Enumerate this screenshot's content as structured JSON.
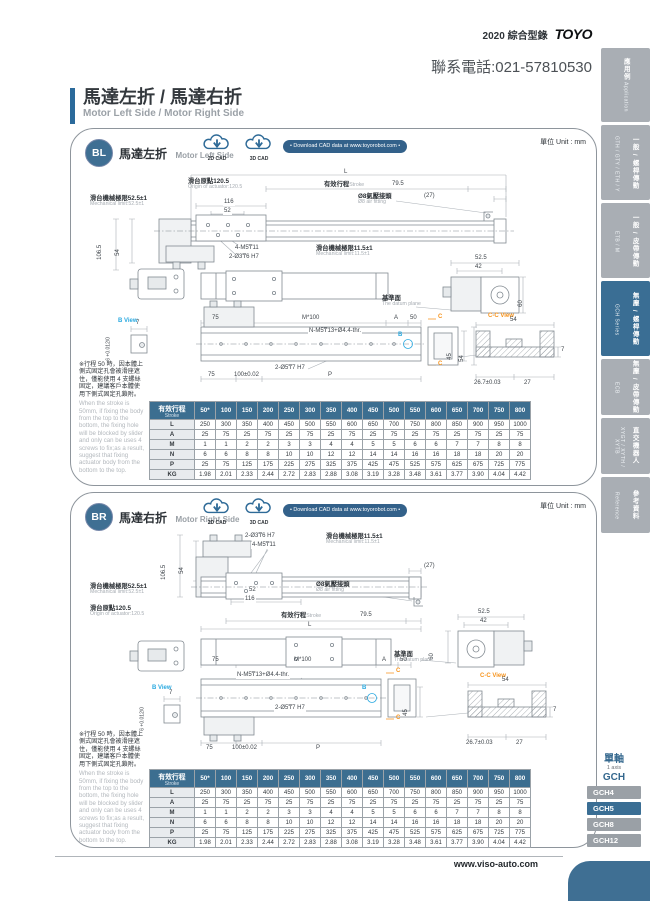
{
  "page": {
    "catalog": "2020 綜合型錄",
    "brand": "TOYO",
    "phone": "聯系電話:021-57810530",
    "unit": "單位 Unit : mm",
    "website": "www.viso-auto.com"
  },
  "title": {
    "zh": "馬達左折 / 馬達右折",
    "en": "Motor Left Side / Motor Right Side"
  },
  "sidebar": {
    "tabs": [
      {
        "zh": "應用例",
        "en": "Application",
        "active": false
      },
      {
        "zh": "一般 / 螺桿傳動",
        "en": "GTH / GTY / ETH / Y",
        "active": false
      },
      {
        "zh": "一般 / 皮帶傳動",
        "en": "ETB / M",
        "active": false
      },
      {
        "zh": "無塵 / 螺桿傳動",
        "en": "GCH Series",
        "active": true
      },
      {
        "zh": "無塵 / 皮帶傳動",
        "en": "ECB",
        "active": false
      },
      {
        "zh": "直交機器人",
        "en": "XYGT / XYTH / XYTB",
        "active": false
      },
      {
        "zh": "參考資料",
        "en": "Reference",
        "active": false
      }
    ],
    "series_nav": {
      "title_zh": "單軸",
      "title_en": "1 axis",
      "series": "GCH",
      "items": [
        {
          "label": "GCH4",
          "active": false
        },
        {
          "label": "GCH5",
          "active": true
        },
        {
          "label": "GCH8",
          "active": false
        },
        {
          "label": "GCH12",
          "active": false
        }
      ]
    }
  },
  "cad": {
    "btn_2d": "2D CAD",
    "btn_3d": "3D CAD",
    "download": "• Download CAD data at www.toyorobot.com •"
  },
  "panels": {
    "bl": {
      "badge": "BL",
      "title_zh": "馬達左折",
      "title_en": "Motor Left Side"
    },
    "br": {
      "badge": "BR",
      "title_zh": "馬達右折",
      "title_en": "Motor Right Side"
    }
  },
  "dims": {
    "L": "L",
    "stroke_zh": "有效行程",
    "stroke_en": "Stroke",
    "origin_zh": "滑台原點120.5",
    "origin_en": "Origin of actuator:120.5",
    "mech52_zh": "滑台機械極限52.5±1",
    "mech52_en": "Mechanical limit:52.5±1",
    "mech115_zh": "滑台機械極限11.5±1",
    "mech115_en": "Mechanical limit:11.5±1",
    "air_zh": "Ø8氣壓接頭",
    "air_en": "Ø8 air fitting",
    "d795": "79.5",
    "d27": "(27)",
    "d116": "116",
    "d52": "52",
    "d1065": "106.5",
    "d54": "54",
    "d45": "45",
    "holes_m5": "4-M5₸11",
    "holes_o3": "2-Ø3₸6 H7",
    "d525": "52.5",
    "d42": "42",
    "d60": "60",
    "datum_zh": "基準面",
    "datum_en": "The datum plane",
    "d75": "75",
    "m100": "M*100",
    "dA": "A",
    "d50": "50",
    "holes_n": "N-M5₸13+Ø4.4-thr.",
    "holes_o5": "2-Ø5₸7 H7",
    "d100": "100±0.02",
    "dP": "P",
    "bview": "B View",
    "d7": "7",
    "btol": "6 +0.012/0",
    "ccview": "C-C View",
    "cc54": "54",
    "cc267": "26.7±0.03",
    "cc27": "27",
    "markB": "B",
    "markC": "C"
  },
  "note": {
    "zh": "※行程 50 時，因本體上側式固定孔會被滑座遮住，僅能使用 4 支螺絲固定，建議客戶本體使用下側式固定孔鎖附。",
    "en": "When the stroke is 50mm, if fixing the body from the top to the bottom, the fixing hole will be blocked by slider and only can be uses 4 screws to fix;as a result, suggest that fixing actuator body from the bottom to the top."
  },
  "table": {
    "header_zh": "有效行程",
    "header_en": "Stroke",
    "strokes": [
      "50*",
      "100",
      "150",
      "200",
      "250",
      "300",
      "350",
      "400",
      "450",
      "500",
      "550",
      "600",
      "650",
      "700",
      "750",
      "800"
    ],
    "rows": [
      {
        "label": "L",
        "values": [
          "250",
          "300",
          "350",
          "400",
          "450",
          "500",
          "550",
          "600",
          "650",
          "700",
          "750",
          "800",
          "850",
          "900",
          "950",
          "1000"
        ]
      },
      {
        "label": "A",
        "values": [
          "25",
          "75",
          "25",
          "75",
          "25",
          "75",
          "25",
          "75",
          "25",
          "75",
          "25",
          "75",
          "25",
          "75",
          "25",
          "75"
        ]
      },
      {
        "label": "M",
        "values": [
          "1",
          "1",
          "2",
          "2",
          "3",
          "3",
          "4",
          "4",
          "5",
          "5",
          "6",
          "6",
          "7",
          "7",
          "8",
          "8"
        ]
      },
      {
        "label": "N",
        "values": [
          "6",
          "6",
          "8",
          "8",
          "10",
          "10",
          "12",
          "12",
          "14",
          "14",
          "16",
          "16",
          "18",
          "18",
          "20",
          "20"
        ]
      },
      {
        "label": "P",
        "values": [
          "25",
          "75",
          "125",
          "175",
          "225",
          "275",
          "325",
          "375",
          "425",
          "475",
          "525",
          "575",
          "625",
          "675",
          "725",
          "775"
        ]
      },
      {
        "label": "KG",
        "values": [
          "1.98",
          "2.01",
          "2.33",
          "2.44",
          "2.72",
          "2.83",
          "2.88",
          "3.08",
          "3.19",
          "3.28",
          "3.48",
          "3.61",
          "3.77",
          "3.90",
          "4.04",
          "4.42"
        ]
      }
    ]
  }
}
